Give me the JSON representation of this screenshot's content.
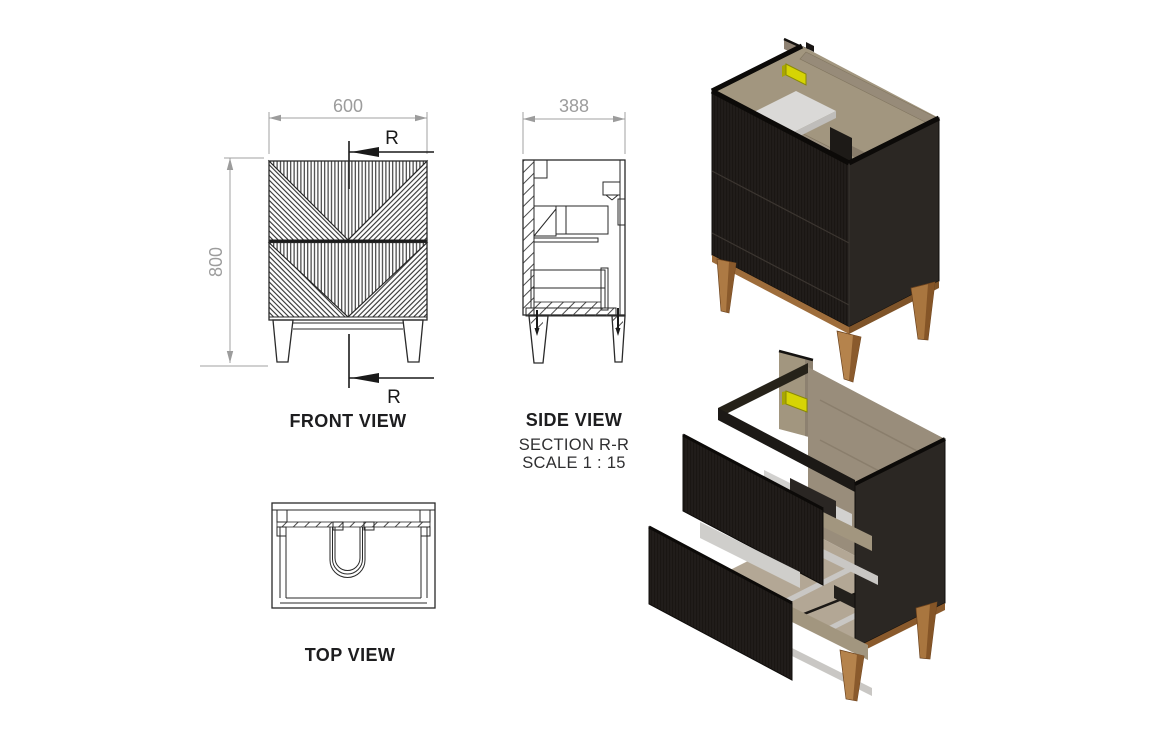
{
  "views": {
    "front": {
      "label": "FRONT VIEW",
      "width_mm": "600",
      "height_mm": "800",
      "section_marker": "R"
    },
    "side": {
      "label": "SIDE VIEW",
      "section_title": "SECTION R-R",
      "scale": "SCALE 1 : 15",
      "depth_mm": "388"
    },
    "top": {
      "label": "TOP VIEW"
    }
  },
  "colors": {
    "line": "#2a2a2a",
    "dimension_gray": "#9c9c9c",
    "panel_black_front": "#211d1a",
    "panel_black_side": "#2b2723",
    "wood_oak": "#a2967f",
    "wood_leg_light": "#b5834c",
    "wood_leg_dark": "#8a5a2c",
    "interior_white": "#dad9d7",
    "runner_gray": "#c9c7c4",
    "clip_yellow": "#d6d404"
  }
}
